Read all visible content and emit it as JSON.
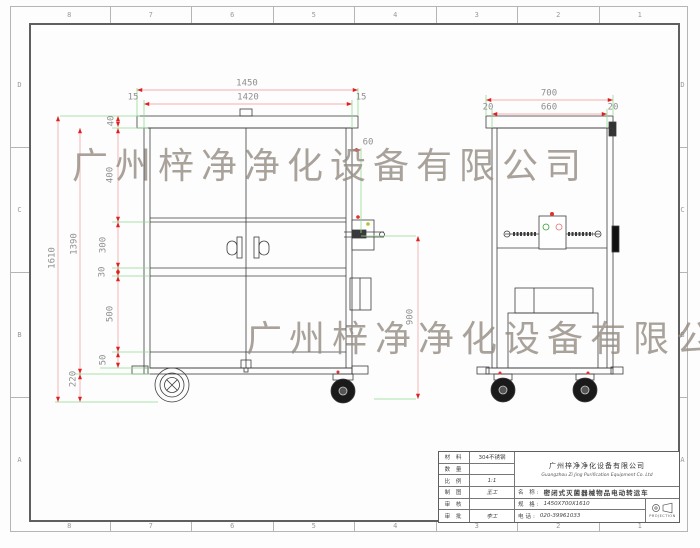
{
  "watermark": {
    "text": "广州梓净净化设备有限公司"
  },
  "grid": {
    "cols": [
      "8",
      "7",
      "6",
      "5",
      "4",
      "3",
      "2",
      "1"
    ],
    "rows": [
      "D",
      "C",
      "B",
      "A"
    ]
  },
  "dims": {
    "front": {
      "overall_w": "1450",
      "inner_w": "1420",
      "inset_l": "15",
      "inset_r": "15",
      "lid": "40",
      "upper": "400",
      "mid": "300",
      "rail": "30",
      "lower": "500",
      "base": "50",
      "total_h": "1610",
      "body_h": "1390",
      "ground": "220",
      "handle_h": "900",
      "box_off": "60"
    },
    "side": {
      "overall_w": "700",
      "inner_w": "660",
      "inset_l": "20",
      "inset_r": "20"
    }
  },
  "title_block": {
    "rows": [
      {
        "label": "材 料",
        "value": "304不锈钢"
      },
      {
        "label": "数 量",
        "value": ""
      },
      {
        "label": "比 例",
        "value": "1:1"
      },
      {
        "label": "制 图",
        "value": "王工"
      },
      {
        "label": "审 核",
        "value": ""
      },
      {
        "label": "审 批",
        "value": "李工"
      }
    ],
    "company_cn": "广州梓净净化设备有限公司",
    "company_en": "Guangzhou Zi Jing Purification Equipment Co. Ltd",
    "name_label": "名 称:",
    "name_value": "密闭式灭菌器械物品电动转运车",
    "spec_label": "规 格:",
    "spec_value": "1450X700X1610",
    "phone_label": "电话:",
    "phone_value": "020-39961033",
    "projection_label": "PROJECTION"
  },
  "colors": {
    "line": "#3c3c3c",
    "dim_line": "#f2b0b0",
    "arrow": "#e02020",
    "extension": "#8fdc8f",
    "dim_text": "#8f8f8f"
  }
}
